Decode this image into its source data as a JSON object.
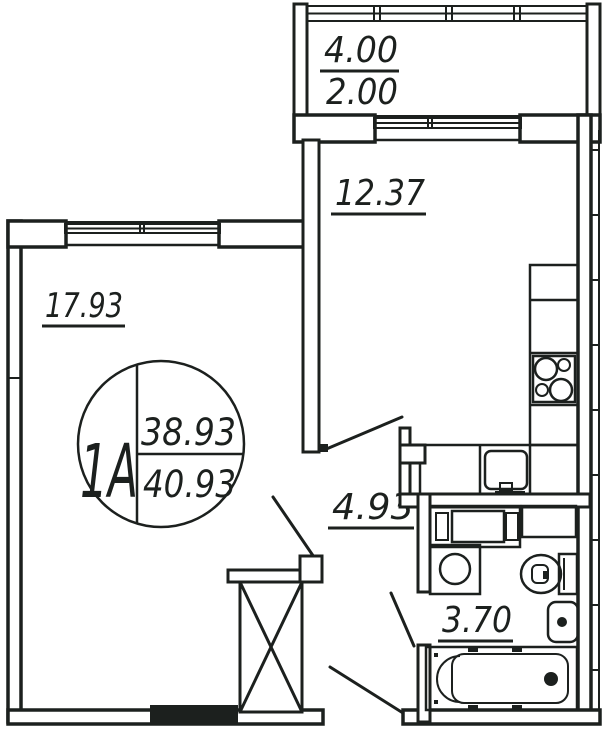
{
  "drawing": {
    "type": "apartment-floor-plan",
    "colors": {
      "line": "#1c201e",
      "background": "#ffffff"
    }
  },
  "unit_stamp": {
    "unit": "1A",
    "area_living": "38.93",
    "area_total": "40.93"
  },
  "rooms": {
    "balcony": {
      "area_full": "4.00",
      "area_reduced": "2.00"
    },
    "kitchen": {
      "area": "12.37"
    },
    "living_room": {
      "area": "17.93"
    },
    "hallway": {
      "area": "4.93"
    },
    "bathroom": {
      "area": "3.70"
    }
  }
}
